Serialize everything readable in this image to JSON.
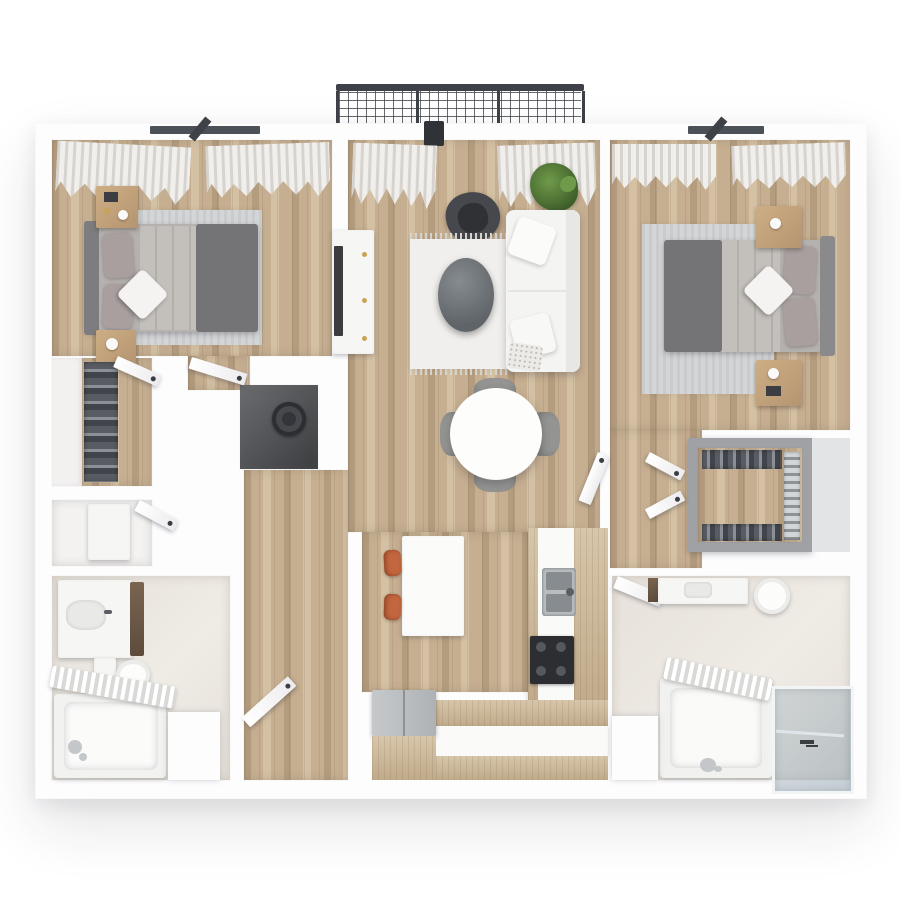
{
  "scene": {
    "kind": "3d-floorplan-top-down-render",
    "unit": "two-bedroom apartment",
    "rooms": [
      {
        "name": "balcony",
        "items": [
          "railing-mesh"
        ]
      },
      {
        "name": "bedroom-left",
        "items": [
          "window",
          "curtains",
          "area-rug",
          "double-bed",
          "nightstand",
          "nightstand",
          "door"
        ]
      },
      {
        "name": "living-room",
        "items": [
          "balcony-door",
          "curtains",
          "tv-console",
          "tv",
          "accent-chair",
          "plant",
          "sofa",
          "area-rug",
          "oval-coffee-table",
          "dining-table",
          "dining-chairs"
        ]
      },
      {
        "name": "bedroom-right",
        "items": [
          "window",
          "curtains",
          "area-rug",
          "double-bed",
          "nightstand",
          "nightstand",
          "door"
        ]
      },
      {
        "name": "walk-in-closet-left",
        "items": [
          "hanging-clothes",
          "door"
        ]
      },
      {
        "name": "utility-closet",
        "items": [
          "washer"
        ]
      },
      {
        "name": "storage-room",
        "items": [
          "cabinet",
          "door"
        ]
      },
      {
        "name": "kitchen",
        "items": [
          "island",
          "bar-stools",
          "sink",
          "cooktop",
          "refrigerator",
          "counters"
        ]
      },
      {
        "name": "bathroom-left",
        "items": [
          "vanity",
          "toilet",
          "bathtub",
          "shower-curtain",
          "door"
        ]
      },
      {
        "name": "walk-in-closet-right",
        "items": [
          "hanging-clothes",
          "shelves",
          "doors"
        ]
      },
      {
        "name": "bathroom-right",
        "items": [
          "vanity",
          "toilet",
          "bathtub",
          "shower-curtain",
          "glass-shower",
          "door"
        ]
      }
    ]
  },
  "colors": {
    "wall": "#fdfdfe",
    "wood-dark": "#b49c7e",
    "wood-base": "#c6ae90",
    "wood-light": "#d4c0a3",
    "wood2-base": "#d8c6aa",
    "wood2-dark": "#c0aa8a",
    "tile": "#e6e1da",
    "rug-gray": "#c9cbcd",
    "rug-gray2": "#d3d5d6",
    "rug-white": "#f0efed",
    "fringe": "#d8d5d0",
    "bed-base": "#b5b1af",
    "headboard": "#7d7c7e",
    "blanket-dark": "#747477",
    "sheet": "#c3bfbb",
    "pillow": "#a89f9e",
    "pillow-white": "#f5f3f1",
    "sofa": "#f4f4f2",
    "sofa-back": "#e7e7e4",
    "armchair": "#46484d",
    "armchair-seat": "#2f3135",
    "marble-1": "#868b8f",
    "marble-2": "#5f6468",
    "plant-1": "#6f9a4a",
    "plant-2": "#3f5f2a",
    "table-white": "#fdfdfc",
    "chair-gray": "#949492",
    "stool-orange": "#c2663f",
    "stool-dark": "#8e4526",
    "island": "#fbfbfa",
    "steel-1": "#c6c9cc",
    "steel-2": "#aeb2b5",
    "cooktop": "#2c2e31",
    "burner": "#55585c",
    "dkwood-1": "#7a6450",
    "dkwood-2": "#5d4c3c",
    "fixture": "#f6f6f4",
    "basin": "#e9e9e7",
    "glass-1": "rgba(164,180,190,0.40)",
    "glass-2": "rgba(146,164,176,0.52)",
    "curtain-a": "#d6d3cf",
    "curtain-b": "#f1efec",
    "railing": "#3e4248",
    "frame-dark": "#4c5057",
    "clothes-a": "#595d63",
    "clothes-b": "#8b9096",
    "clothes-c": "#41444a",
    "closet-frame": "#9fa1a4",
    "utility-1": "#6a6c70",
    "utility-2": "#3b3d41",
    "gold": "#c9a254",
    "shadow-warm": "rgba(110,100,88,0.24)"
  }
}
